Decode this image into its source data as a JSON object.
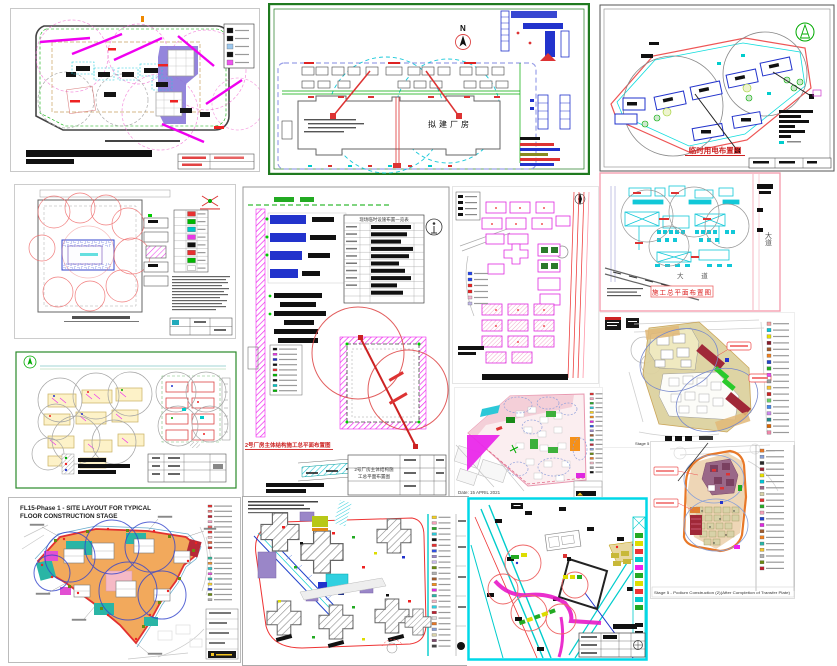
{
  "page": {
    "background": "#ffffff"
  },
  "palette": {
    "magenta": "#ee22ee",
    "cyan": "#12c8d8",
    "red": "#e03030",
    "green": "#00aa00",
    "blue": "#2233cc",
    "purple_fill": "#8878d8",
    "orange_fill": "#f2a95c",
    "tan_fill": "#ddd2a0",
    "teal_fill": "#2ab5a5",
    "dark_red": "#a02838",
    "pink_fill": "#f4cfd8",
    "green_border": "#1f7a1f",
    "pink_border": "#f4a0b0"
  },
  "drawings": {
    "a": {
      "legend_chips": [
        "#111111",
        "#111111",
        "#9cc8ee",
        "#111111",
        "#ee55ee"
      ]
    },
    "b": {
      "north_label": "N",
      "building_label": "拟建厂房"
    },
    "c": {
      "title": "临时用电布置图"
    },
    "d": {
      "legend_chips": [
        "#e83030",
        "#00b800",
        "#00c8c8",
        "#e838e8",
        "#111111",
        "#e83030",
        "#00b800",
        "#ffffff"
      ]
    },
    "e": {
      "title": "2号厂房主体结构施工总平面布置图",
      "table_title": "现场临时设施布置一览表",
      "block_line1": "2号厂房主体结构施",
      "block_line2": "工总平面布置图",
      "legend_chips": [
        "#111111",
        "#e838e8",
        "#2233cc",
        "#111111",
        "#e83030",
        "#00b800",
        "#111111",
        "#00c8c8",
        "#00b800"
      ]
    },
    "f": {
      "legend_chips": [
        "#2244ee",
        "#2244ee",
        "#ee2222",
        "#ee2222",
        "#f4b8d0",
        "#c0b8e8"
      ]
    },
    "g": {
      "title": "施工总平面布置图",
      "road_label_vertical": "大道",
      "road_label_bottom": "大 道"
    },
    "h": {
      "caption": "Stage 5 - Podium Construction (2)/After Completion of Transfer Plate",
      "legend_chips": [
        "#f4a0a0",
        "#00c8d8",
        "#e8e000",
        "#8b1a2a",
        "#a05a2c",
        "#f08020",
        "#2244cc",
        "#22aa22",
        "#ee44ee",
        "#999999",
        "#f4c430",
        "#cc2222",
        "#66cc66",
        "#4488ee",
        "#cc88ee",
        "#228888",
        "#dd6600",
        "#ee88aa"
      ]
    },
    "i": {},
    "j": {
      "date_label": "Date: 15 APRIL 2021",
      "legend_chips": [
        "#e83030",
        "#f4a0b8",
        "#28a828",
        "#2cc8d8",
        "#f4d020",
        "#f59018",
        "#e028e0",
        "#3050e0",
        "#9a86c8",
        "#a05a2c",
        "#2ab5a5",
        "#c02838",
        "#88a0d8",
        "#6a8a10",
        "#e87828",
        "#f6bac6",
        "#999999",
        "#111111"
      ]
    },
    "k": {
      "title_line1": "FL15-Phase 1 - SITE LAYOUT FOR TYPICAL",
      "title_line2": "FLOOR CONSTRUCTION STAGE",
      "legend_chips": [
        "#e83030",
        "#f08080",
        "#c02030",
        "#f4a0c0",
        "#e86060",
        "#e83030",
        "#f4c0c0",
        "#e06040",
        "#cc2020"
      ],
      "legend_chips2": [
        "#30b898",
        "#f09030",
        "#28c8c8",
        "#e84fd8",
        "#2ab5a5",
        "#f4d030",
        "#3050e0",
        "#6a8a10",
        "#b0b0b0"
      ]
    },
    "l": {
      "legend_chips": [
        "#f4d020",
        "#f4a0b8",
        "#28a828",
        "#2cc8d8",
        "#111111",
        "#e83030",
        "#3050e0",
        "#9a86c8",
        "#c8b8e8",
        "#6a8a10",
        "#b0b0b0",
        "#a05a2c",
        "#f59018",
        "#e028e0",
        "#2ab5a5",
        "#f6bac6",
        "#30d0e0",
        "#c02030",
        "#dddddd",
        "#e87828",
        "#88a0d8",
        "#d8d2a8",
        "#7a4868",
        "#444444"
      ]
    },
    "m": {},
    "n": {
      "caption": "Stage 5 - Podium Construction (2)(After Completion of Transfer Plate)",
      "legend_chips": [
        "#e87828",
        "#88a0d8",
        "#2a2a2a",
        "#a02838",
        "#e8e000",
        "#00c8d8",
        "#9a6888",
        "#d8d2a8",
        "#e83030",
        "#28a828",
        "#f4a0b8",
        "#2244cc",
        "#e028e0",
        "#a05a2c",
        "#f08020",
        "#2ab5a5",
        "#f4c430",
        "#b0b0b0",
        "#6a8a10",
        "#c02030"
      ]
    }
  }
}
